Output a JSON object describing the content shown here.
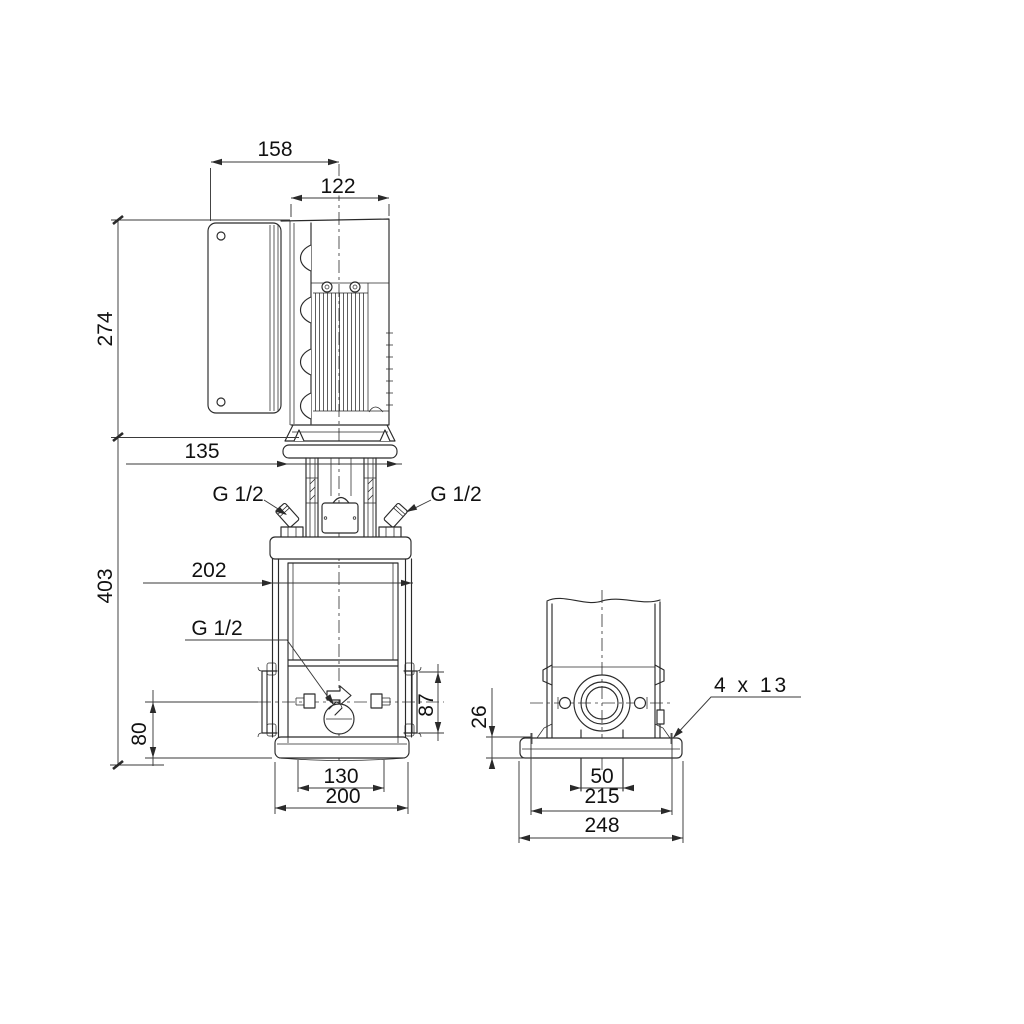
{
  "page": {
    "background": "#ffffff",
    "line_color": "#2a2a2a",
    "text_color": "#111111"
  },
  "drawing": {
    "labels": {
      "dim_158": "158",
      "dim_122": "122",
      "dim_274": "274",
      "dim_135": "135",
      "dim_403": "403",
      "dim_202": "202",
      "port_left": "G 1/2",
      "port_right": "G 1/2",
      "drain": "G 1/2",
      "dim_87": "87",
      "dim_80": "80",
      "dim_130": "130",
      "dim_200": "200",
      "dim_26": "26",
      "bolt_holes": "4 x 13",
      "dim_50": "50",
      "dim_215": "215",
      "dim_248": "248"
    }
  }
}
